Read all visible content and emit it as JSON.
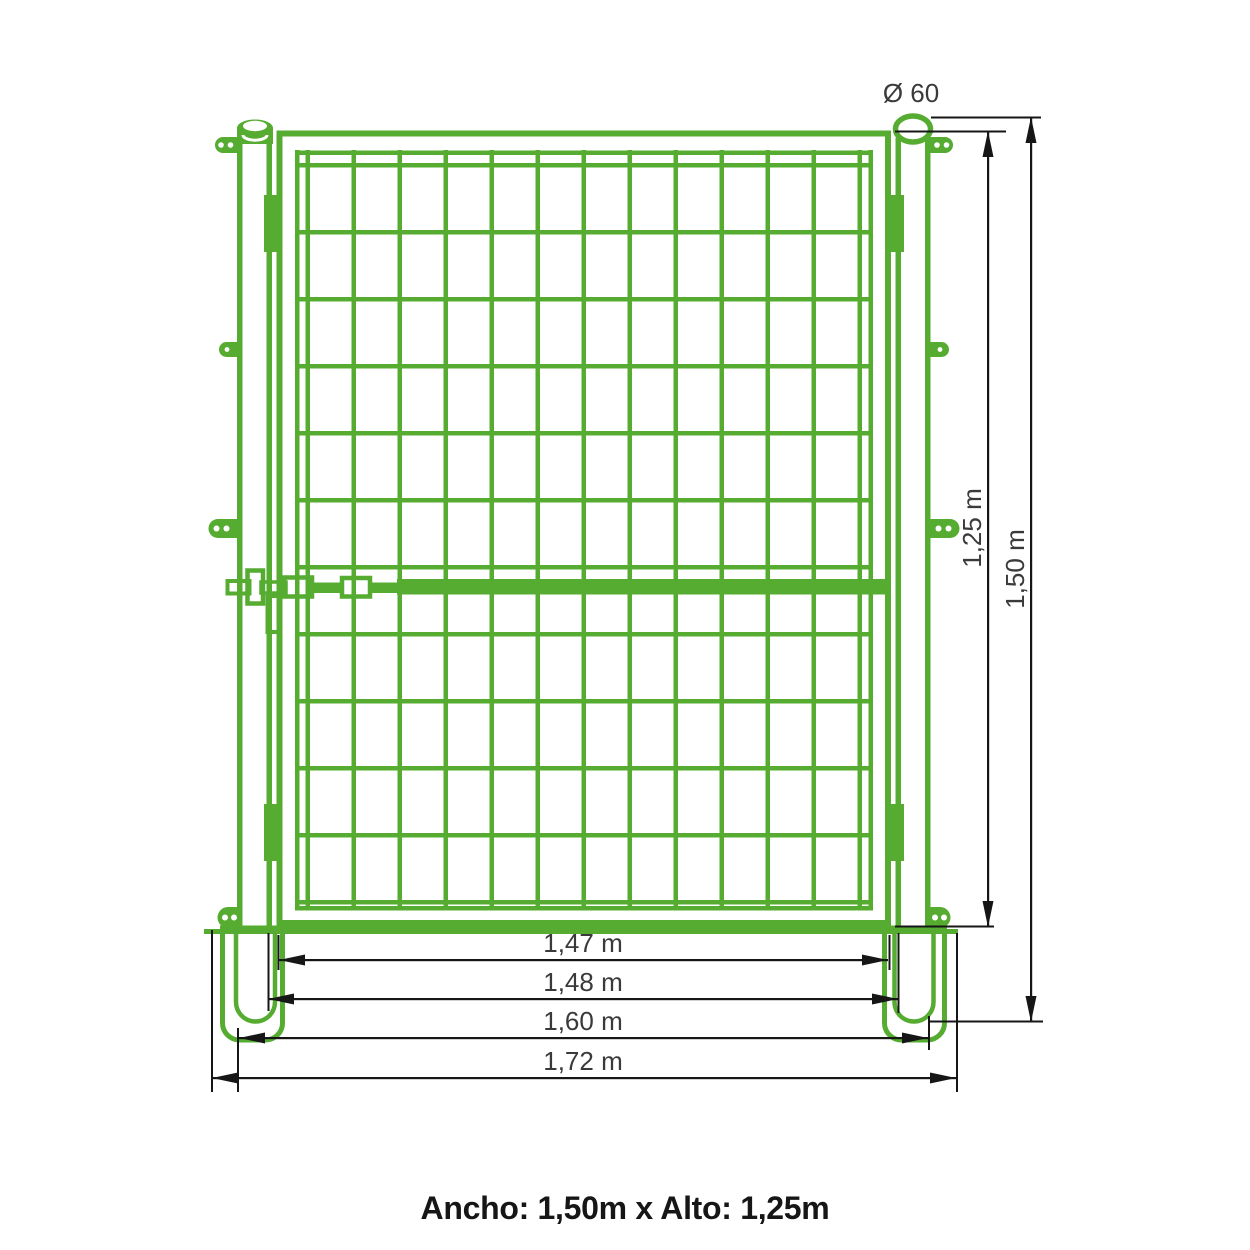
{
  "drawing": {
    "type": "gate-technical-drawing",
    "caption": "Ancho: 1,50m x Alto: 1,25m",
    "dimensions": {
      "post_diameter": "Ø 60",
      "gate_height": "1,25 m",
      "post_height": "1,50 m",
      "gate_leaf_width": "1,47 m",
      "clear_opening_width": "1,48 m",
      "posts_outer_width": "1,60 m",
      "footings_outer_width": "1,72 m"
    },
    "colors": {
      "green": "#55ac31",
      "dimension_line": "#161616",
      "dimension_text": "#3a3a3a",
      "caption_text": "#161616",
      "concrete_base": "#c9c9c9",
      "background": "#ffffff"
    }
  }
}
